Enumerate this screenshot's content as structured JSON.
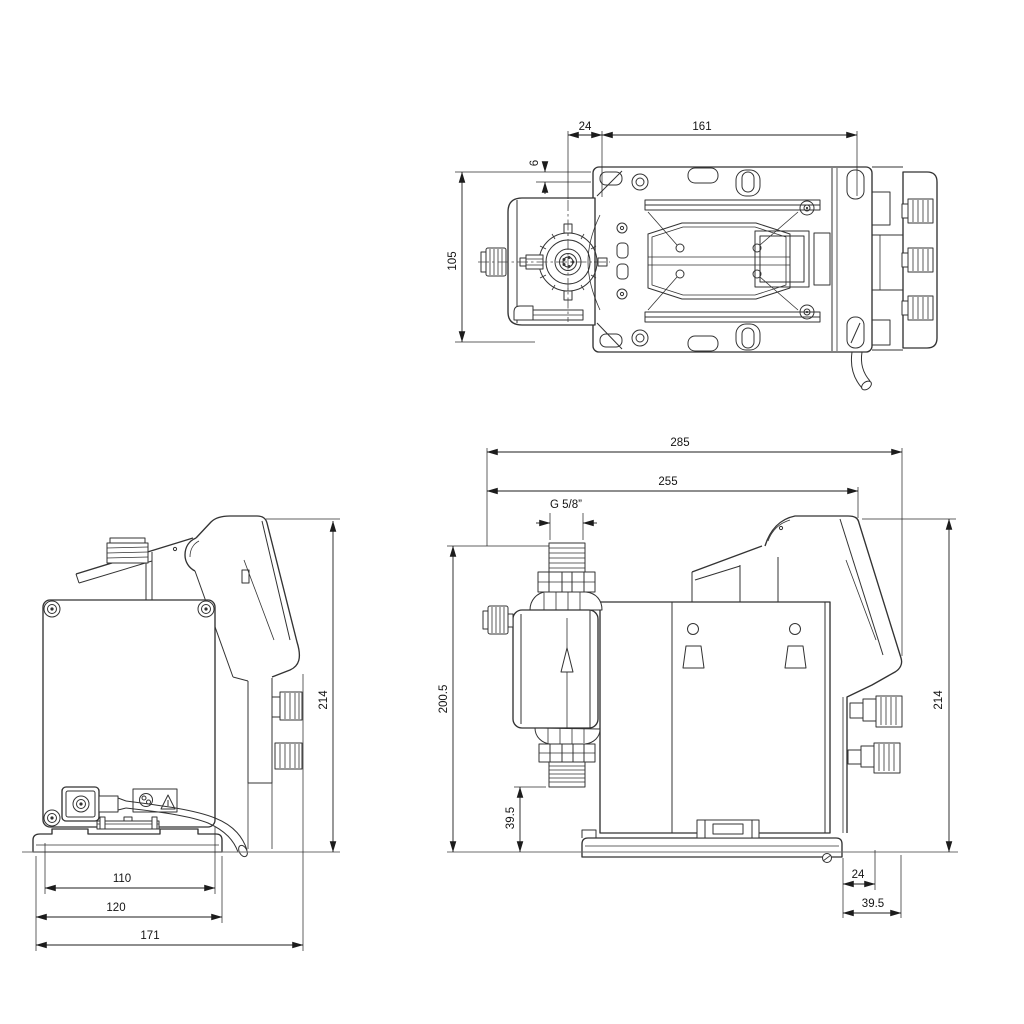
{
  "views": {
    "top": {
      "dims": {
        "w24": "24",
        "w161": "161",
        "h6": "6",
        "h105": "105"
      }
    },
    "left": {
      "dims": {
        "h214": "214",
        "w110": "110",
        "w120": "120",
        "w171": "171"
      }
    },
    "right": {
      "dims": {
        "w285": "285",
        "w255": "255",
        "thread": "G 5/8”",
        "h200_5": "200.5",
        "h39_5_head": "39.5",
        "h214": "214",
        "w24": "24",
        "w39_5_knob": "39.5"
      }
    }
  },
  "colors": {
    "line": "#333333",
    "dimension": "#1c1c1c",
    "background": "#ffffff",
    "ground": "#6e6e6e"
  }
}
